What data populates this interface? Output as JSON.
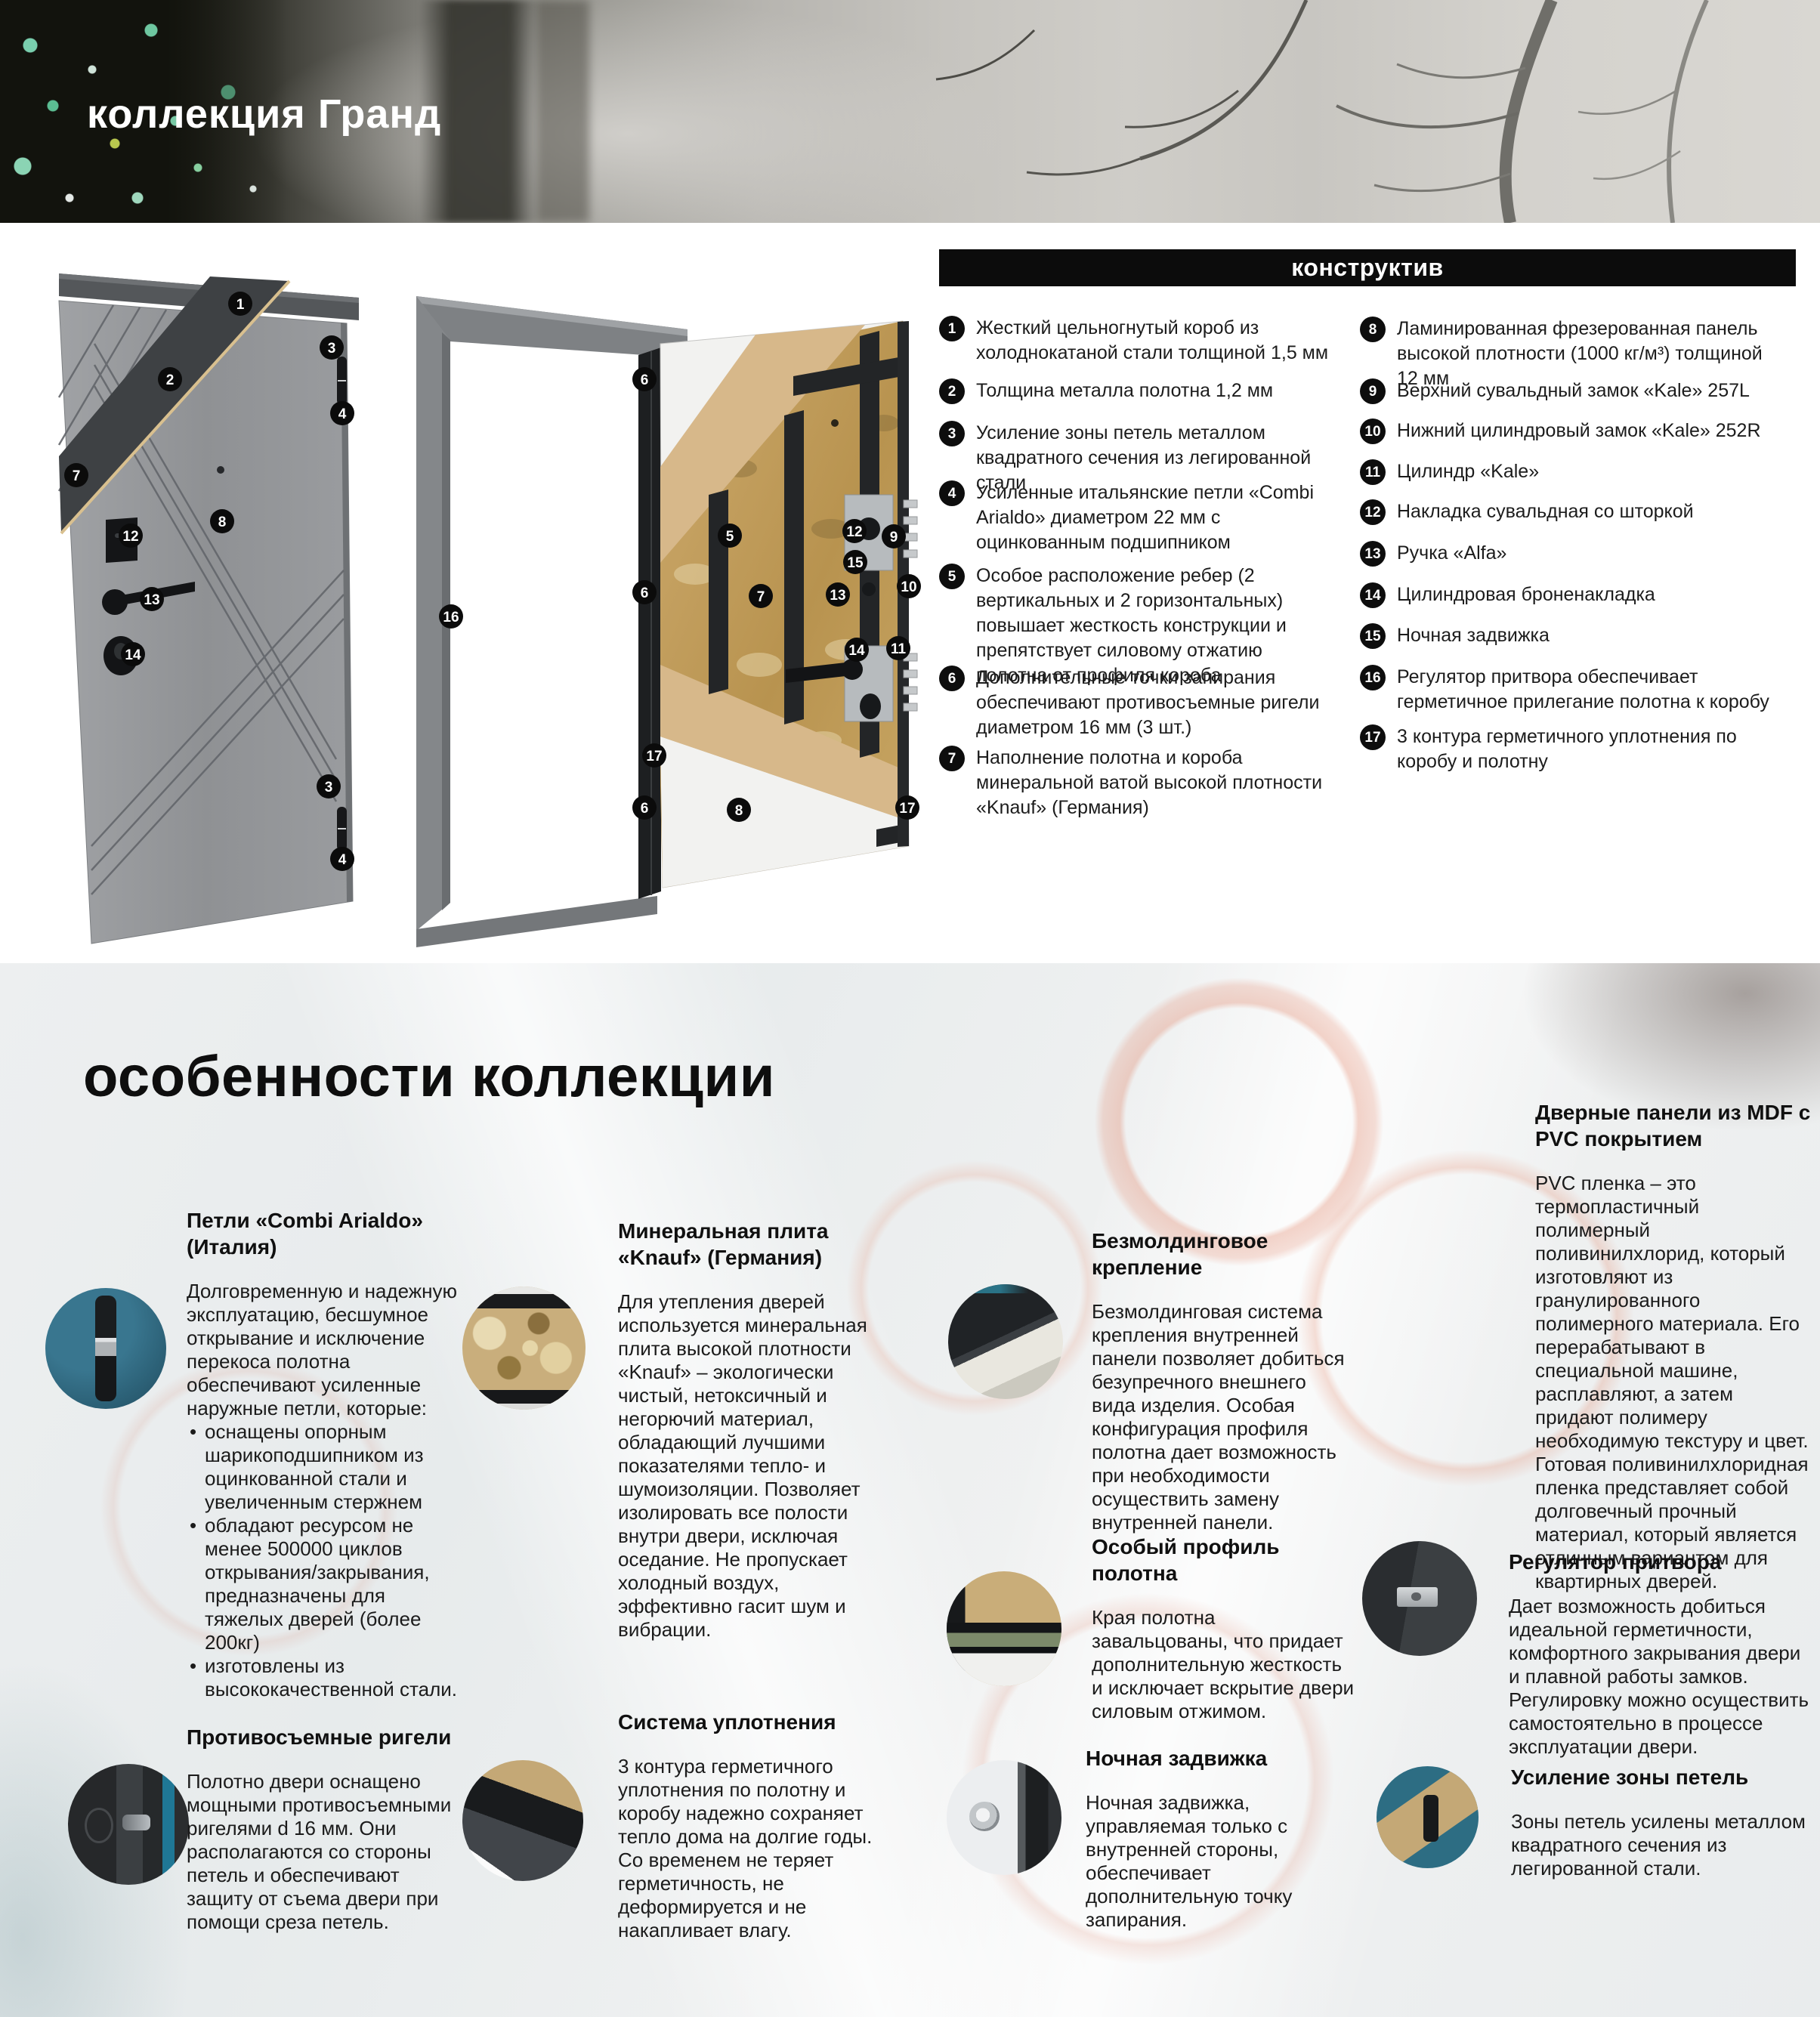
{
  "banner": {
    "title": "коллекция Гранд"
  },
  "colors": {
    "bar_background": "#0c0c0c",
    "badge_black": "#0d0d0d",
    "wool_tan": "#c9ad79",
    "kraft_beige": "#d7b88a",
    "photo_teal": "#2c6177"
  },
  "constructive": {
    "header": "конструктив",
    "left_items": [
      {
        "num": "1",
        "text": "Жесткий цельногнутый короб из холоднокатаной стали толщиной 1,5 мм"
      },
      {
        "num": "2",
        "text": "Толщина металла полотна 1,2 мм"
      },
      {
        "num": "3",
        "text": "Усиление зоны петель металлом квадратного сечения из легированной стали"
      },
      {
        "num": "4",
        "text": "Усиленные итальянские петли «Combi Arialdo» диаметром 22 мм с оцинкованным подшипником"
      },
      {
        "num": "5",
        "text": "Особое расположение ребер (2 вертикальных и 2 горизонтальных) повышает жесткость конструкции и препятствует силовому отжатию полотна от профиля короба"
      },
      {
        "num": "6",
        "text": "Дополнительные точки запирания обеспечивают противосъемные ригели диаметром 16 мм (3 шт.)"
      },
      {
        "num": "7",
        "text": "Наполнение полотна и короба минеральной ватой высокой плотности «Knauf» (Германия)"
      }
    ],
    "right_items": [
      {
        "num": "8",
        "text": "Ламинированная фрезерованная панель высокой плотности (1000 кг/м³) толщиной 12 мм"
      },
      {
        "num": "9",
        "text": "Верхний сувальдный замок «Kale» 257L"
      },
      {
        "num": "10",
        "text": "Нижний цилиндровый замок «Kale» 252R"
      },
      {
        "num": "11",
        "text": "Цилиндр «Kale»"
      },
      {
        "num": "12",
        "text": "Накладка сувальдная со шторкой"
      },
      {
        "num": "13",
        "text": "Ручка «Alfa»"
      },
      {
        "num": "14",
        "text": "Цилиндровая броненакладка"
      },
      {
        "num": "15",
        "text": "Ночная задвижка"
      },
      {
        "num": "16",
        "text": "Регулятор притвора обеспечивает герметичное прилегание полотна к коробу"
      },
      {
        "num": "17",
        "text": "3 контура герметичного уплотнения по коробу и полотну"
      }
    ]
  },
  "diagram": {
    "door1_marker_labels": [
      "1",
      "2",
      "3",
      "4",
      "7",
      "8",
      "12",
      "13",
      "14",
      "3",
      "4"
    ],
    "door2_marker_labels": [
      "6",
      "6",
      "6",
      "5",
      "7",
      "8",
      "12",
      "9",
      "15",
      "10",
      "13",
      "14",
      "11",
      "16",
      "17",
      "17"
    ]
  },
  "features_section": {
    "title": "особенности коллекции",
    "features": [
      {
        "id": "hinges",
        "title": "Петли «Combi Arialdo» (Италия)",
        "intro": "Долговременную и надежную эксплуатацию, бесшумное открывание и исключение перекоса полотна обеспечивают усиленные наружные петли, которые:",
        "bullets": [
          "оснащены опорным шарикоподшипником из оцинкованной стали и увеличенным стержнем",
          "обладают ресурсом не менее 500000 циклов открывания/закрывания, предназначены для тяжелых дверей (более 200кг)",
          "изготовлены из высококачественной стали."
        ]
      },
      {
        "id": "mineral-board",
        "title": "Минеральная плита «Knauf» (Германия)",
        "text": "Для утепления дверей используется минеральная плита высокой плотности «Knauf» – экологически чистый, нетоксичный и негорючий материал, обладающий лучшими показателями тепло- и шумоизоляции. Позволяет изолировать все полости внутри двери, исключая оседание. Не пропускает холодный воздух, эффективно гасит шум и вибрации."
      },
      {
        "id": "moldingless",
        "title": "Безмолдинговое крепление",
        "text": "Безмолдинговая система крепления внутренней панели позволяет добиться безупречного внешнего вида изделия. Особая конфигурация профиля полотна дает возможность при необходимости осуществить замену внутренней панели."
      },
      {
        "id": "mdf-pvc",
        "title": "Дверные панели из MDF с PVC покрытием",
        "text": "PVC пленка – это термопластичный полимерный поливинилхлорид, который изготовляют из гранулированного полимерного материала. Его перерабатывают в специальной машине, расплавляют, а затем придают полимеру необходимую текстуру и цвет. Готовая поливинилхлоридная пленка представляет собой долговечный прочный материал, который является отличным вариантом для квартирных дверей."
      },
      {
        "id": "leaf-profile",
        "title": "Особый профиль полотна",
        "text": "Края полотна завальцованы, что придает дополнительную жесткость и исключает вскрытие двери силовым отжимом."
      },
      {
        "id": "rebate-adjuster",
        "title": "Регулятор притвора",
        "text": "Дает возможность добиться идеальной герметичности, комфортного закрывания двери и плавной работы замков. Регулировку можно осуществить самостоятельно в процессе эксплуатации двери."
      },
      {
        "id": "anti-removal-bolts",
        "title": "Противосъемные ригели",
        "text": "Полотно двери оснащено мощными противосъемными ригелями d 16 мм. Они располагаются со стороны петель и обеспечивают защиту от съема двери при помощи среза петель."
      },
      {
        "id": "sealing-system",
        "title": "Система уплотнения",
        "text": "3 контура герметичного уплотнения по полотну и коробу надежно сохраняет тепло дома на долгие годы. Со временем не теряет герметичность, не деформируется и не накапливает влагу."
      },
      {
        "id": "night-latch",
        "title": "Ночная задвижка",
        "text": "Ночная задвижка, управляемая только с внутренней стороны, обеспечивает дополнительную точку запирания."
      },
      {
        "id": "hinge-zone",
        "title": "Усиление зоны петель",
        "text": "Зоны петель усилены металлом квадратного сечения из легированной стали."
      }
    ]
  }
}
